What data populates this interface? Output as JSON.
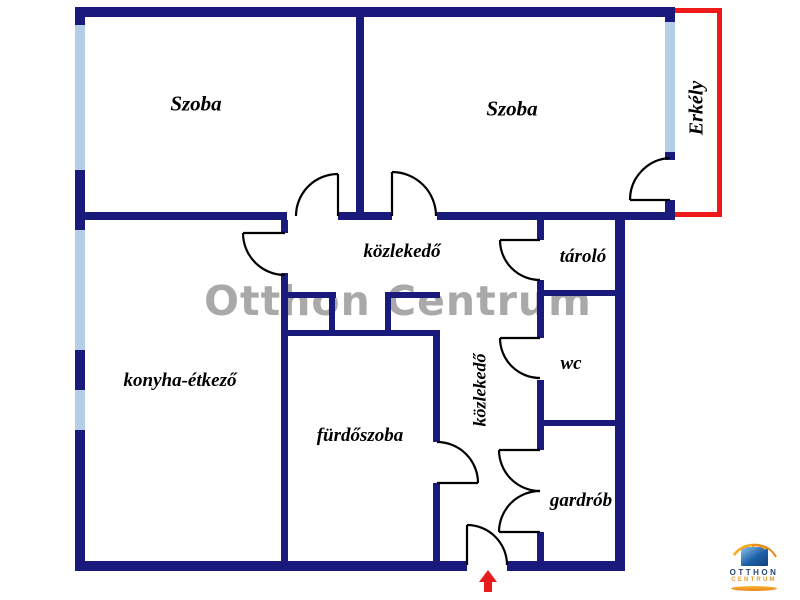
{
  "floorplan": {
    "title_watermark": "Otthon Centrum",
    "rooms": [
      {
        "id": "room-left",
        "label": "Szoba"
      },
      {
        "id": "room-right",
        "label": "Szoba"
      },
      {
        "id": "balcony",
        "label": "Erkély"
      },
      {
        "id": "hallway-upper",
        "label": "közlekedő"
      },
      {
        "id": "storage",
        "label": "tároló"
      },
      {
        "id": "wc",
        "label": "wc"
      },
      {
        "id": "wardrobe",
        "label": "gardrób"
      },
      {
        "id": "hallway-lower",
        "label": "közlekedő"
      },
      {
        "id": "bathroom",
        "label": "fürdőszoba"
      },
      {
        "id": "kitchen-dining",
        "label": "konyha-étkező"
      }
    ],
    "logo": {
      "line1": "OTTHON",
      "line2": "CENTRUM"
    },
    "colors": {
      "wall": "#1a1a7c",
      "window": "#b4cee8",
      "balcony_outline": "#ee1a1a",
      "door_swing": "#000000",
      "watermark": "#a9a9a9",
      "entrance_arrow": "#e61c1c",
      "logo_blue": "#1c5fa8",
      "logo_orange": "#e89b2d"
    },
    "entrance_arrow_direction": "up"
  }
}
